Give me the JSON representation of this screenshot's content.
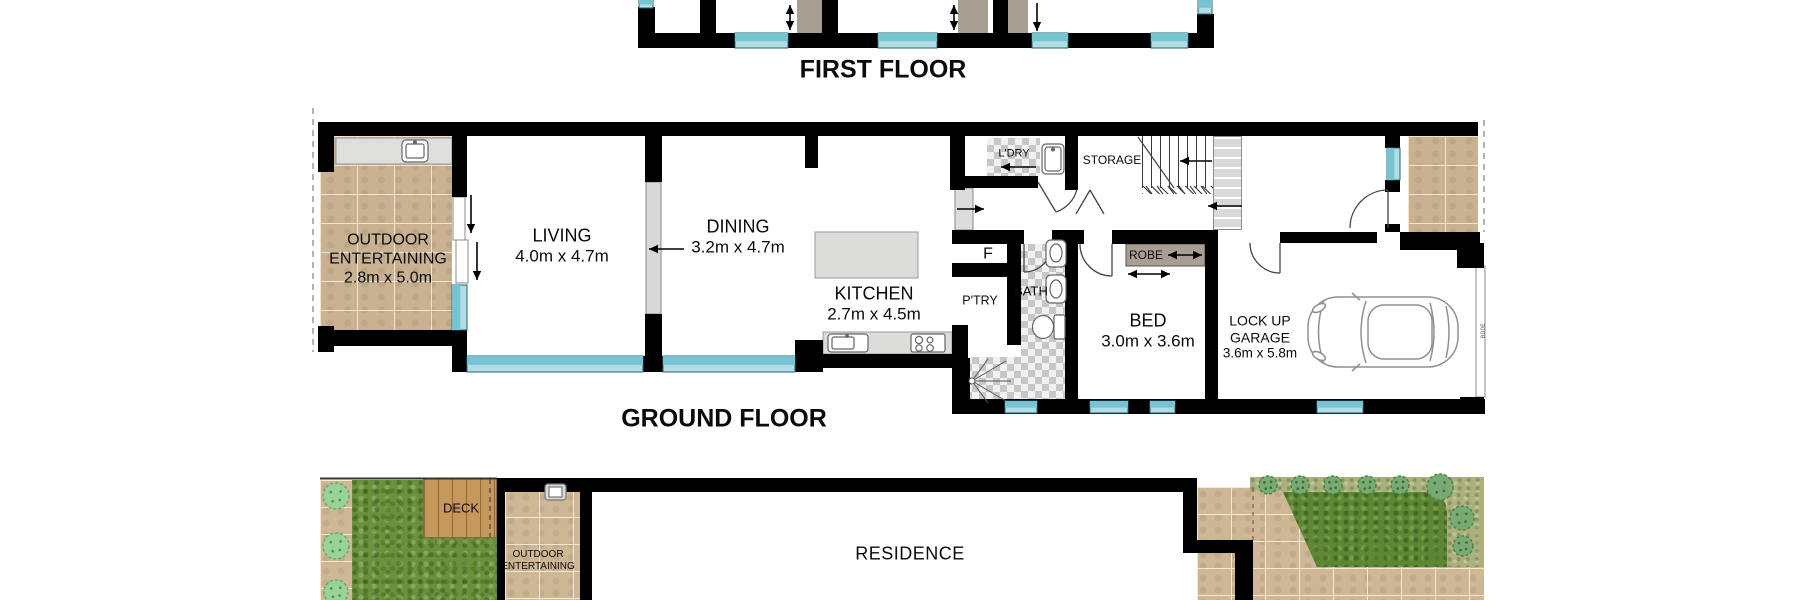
{
  "titles": {
    "first_floor": "FIRST FLOOR",
    "ground_floor": "GROUND FLOOR"
  },
  "ground_floor": {
    "rooms": {
      "outdoor_entertaining": {
        "name": "OUTDOOR ENTERTAINING",
        "dims": "2.8m x 5.0m"
      },
      "living": {
        "name": "LIVING",
        "dims": "4.0m x 4.7m"
      },
      "dining": {
        "name": "DINING",
        "dims": "3.2m x 4.7m"
      },
      "kitchen": {
        "name": "KITCHEN",
        "dims": "2.7m x 4.5m"
      },
      "laundry": {
        "name": "L'DRY"
      },
      "storage": {
        "name": "STORAGE"
      },
      "fridge": {
        "name": "F"
      },
      "pantry": {
        "name": "P'TRY"
      },
      "bath": {
        "name": "BATH"
      },
      "robe": {
        "name": "ROBE"
      },
      "bed": {
        "name": "BED",
        "dims": "3.0m x 3.6m"
      },
      "garage": {
        "name": "LOCK UP GARAGE",
        "dims": "3.6m x 5.8m",
        "door_dim": "3008"
      }
    }
  },
  "site_plan": {
    "residence": "RESIDENCE",
    "deck": "DECK",
    "outdoor_entertaining": "OUTDOOR ENTERTAINING"
  },
  "colors": {
    "wall": "#000000",
    "window": "#76c3d1",
    "window_light": "#b0dce4",
    "paving": "#c9b292",
    "grass": "#6a923d",
    "deck_wood": "#c6985c",
    "bench_gray": "#dededc",
    "wardrobe_taupe": "#a79e93",
    "stairs_gray": "#d9d9d9"
  }
}
